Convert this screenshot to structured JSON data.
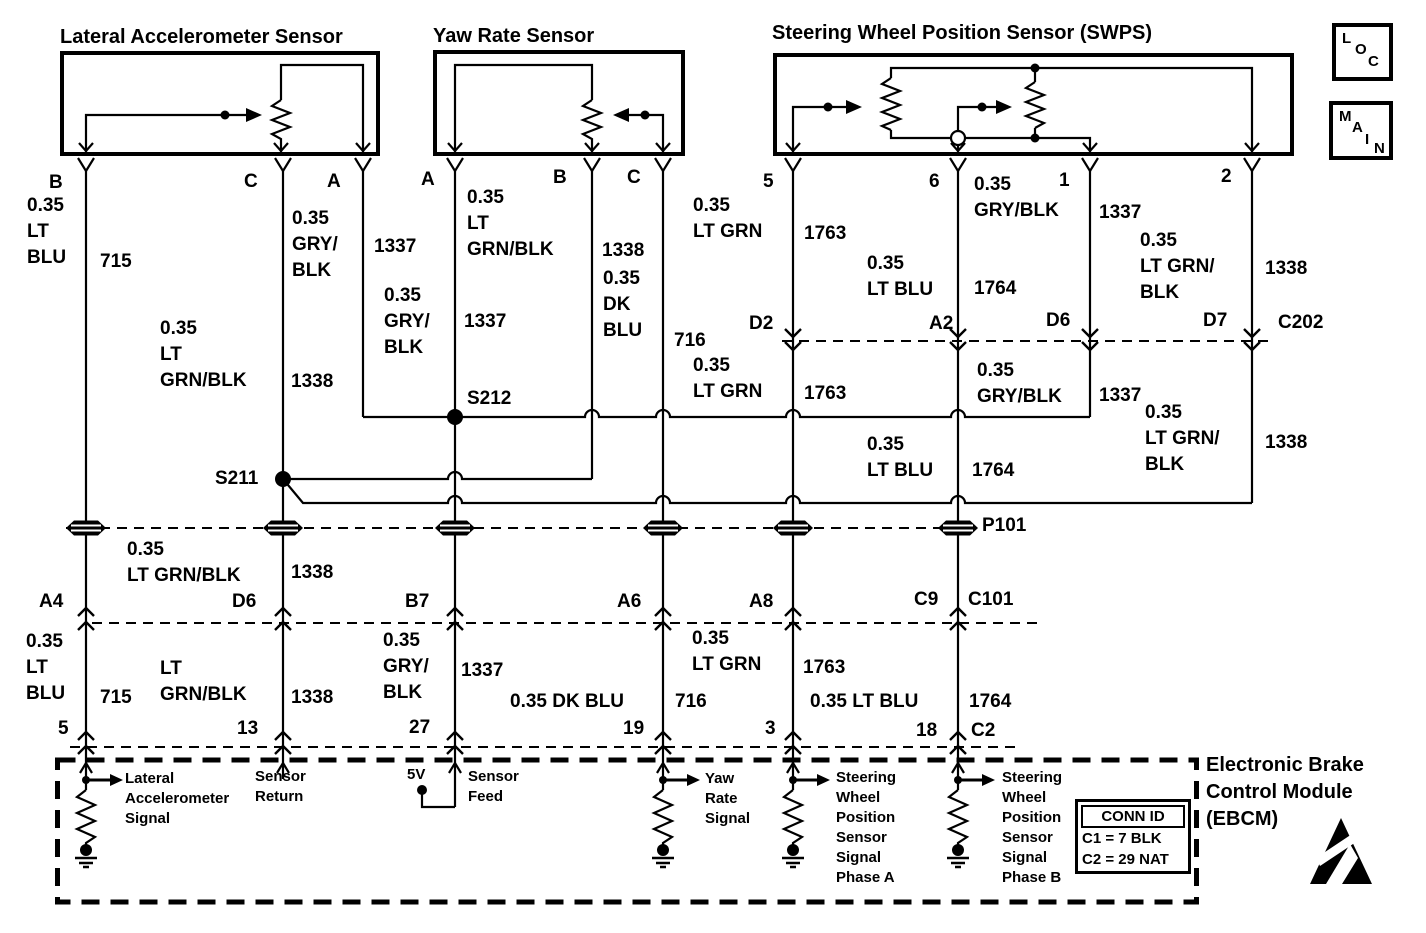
{
  "colors": {
    "ink": "#000000",
    "paper": "#ffffff"
  },
  "nav": {
    "loc": [
      "L",
      "O",
      "C"
    ],
    "main": [
      "M",
      "A",
      "I",
      "N"
    ]
  },
  "conn_id": {
    "title": "CONN ID",
    "rows": [
      "C1 = 7 BLK",
      "C2 = 29 NAT"
    ]
  },
  "ebcm": {
    "title": "Electronic Brake\nControl Module\n(EBCM)"
  },
  "labels": [
    {
      "name": "lateral-accelerometer-sensor-title",
      "text": "Lateral Accelerometer Sensor",
      "x": 60,
      "y": 24,
      "fs": 20
    },
    {
      "name": "yaw-rate-sensor-title",
      "text": "Yaw Rate Sensor",
      "x": 433,
      "y": 23,
      "fs": 20
    },
    {
      "name": "swps-title",
      "text": "Steering Wheel Position Sensor (SWPS)",
      "x": 772,
      "y": 20,
      "fs": 20
    },
    {
      "name": "lat-terminal-b",
      "text": "B",
      "x": 49,
      "y": 170
    },
    {
      "name": "lat-terminal-c",
      "text": "C",
      "x": 244,
      "y": 169
    },
    {
      "name": "lat-terminal-a",
      "text": "A",
      "x": 327,
      "y": 169
    },
    {
      "name": "yaw-terminal-a",
      "text": "A",
      "x": 421,
      "y": 167
    },
    {
      "name": "yaw-terminal-b",
      "text": "B",
      "x": 553,
      "y": 165
    },
    {
      "name": "yaw-terminal-c",
      "text": "C",
      "x": 627,
      "y": 165
    },
    {
      "name": "swps-terminal-5",
      "text": "5",
      "x": 763,
      "y": 169
    },
    {
      "name": "swps-terminal-6",
      "text": "6",
      "x": 929,
      "y": 169
    },
    {
      "name": "swps-terminal-1",
      "text": "1",
      "x": 1059,
      "y": 168
    },
    {
      "name": "swps-terminal-2",
      "text": "2",
      "x": 1221,
      "y": 164
    },
    {
      "name": "wire-715-color-top",
      "text": "0.35\nLT\nBLU",
      "x": 27,
      "y": 193
    },
    {
      "name": "wire-715-circuit-top",
      "text": "715",
      "x": 100,
      "y": 249
    },
    {
      "name": "wire-1337-lat-color",
      "text": "0.35\nGRY/\nBLK",
      "x": 292,
      "y": 206
    },
    {
      "name": "wire-1337-lat-circuit",
      "text": "1337",
      "x": 374,
      "y": 234
    },
    {
      "name": "wire-1338-lat-color",
      "text": "0.35\nLT\nGRN/BLK",
      "x": 160,
      "y": 316
    },
    {
      "name": "wire-1338-lat-circuit",
      "text": "1338",
      "x": 291,
      "y": 369
    },
    {
      "name": "wire-1337-yaw-color",
      "text": "0.35\nGRY/\nBLK",
      "x": 384,
      "y": 283
    },
    {
      "name": "wire-1337-yaw-circuit",
      "text": "1337",
      "x": 464,
      "y": 309
    },
    {
      "name": "wire-1338-yaw-color",
      "text": "0.35\nLT\nGRN/BLK",
      "x": 467,
      "y": 185
    },
    {
      "name": "wire-1338-yaw-circuit",
      "text": "1338",
      "x": 602,
      "y": 238
    },
    {
      "name": "wire-716-color-top",
      "text": "0.35\nDK\nBLU",
      "x": 603,
      "y": 266
    },
    {
      "name": "wire-716-circuit-top",
      "text": "716",
      "x": 674,
      "y": 328
    },
    {
      "name": "wire-1763-color-top",
      "text": "0.35\nLT GRN",
      "x": 693,
      "y": 193
    },
    {
      "name": "wire-1763-circuit-top",
      "text": "1763",
      "x": 804,
      "y": 221
    },
    {
      "name": "wire-1764-color-top",
      "text": "0.35\nLT BLU",
      "x": 867,
      "y": 251
    },
    {
      "name": "wire-1764-circuit-top",
      "text": "1764",
      "x": 974,
      "y": 276
    },
    {
      "name": "wire-1337-swps-color",
      "text": "0.35\nGRY/BLK",
      "x": 974,
      "y": 172
    },
    {
      "name": "wire-1337-swps-circuit",
      "text": "1337",
      "x": 1099,
      "y": 200
    },
    {
      "name": "wire-1338-swps-color",
      "text": "0.35\nLT GRN/\nBLK",
      "x": 1140,
      "y": 228
    },
    {
      "name": "wire-1338-swps-circuit",
      "text": "1338",
      "x": 1265,
      "y": 256
    },
    {
      "name": "splice-s212-label",
      "text": "S212",
      "x": 467,
      "y": 386
    },
    {
      "name": "splice-s211-label",
      "text": "S211",
      "x": 215,
      "y": 466
    },
    {
      "name": "c202-pin-d2",
      "text": "D2",
      "x": 749,
      "y": 311
    },
    {
      "name": "c202-pin-a2",
      "text": "A2",
      "x": 929,
      "y": 311
    },
    {
      "name": "c202-pin-d6",
      "text": "D6",
      "x": 1046,
      "y": 308
    },
    {
      "name": "c202-pin-d7",
      "text": "D7",
      "x": 1203,
      "y": 308
    },
    {
      "name": "c202-label",
      "text": "C202",
      "x": 1278,
      "y": 310
    },
    {
      "name": "wire-1763-color-mid",
      "text": "0.35\nLT GRN",
      "x": 693,
      "y": 353
    },
    {
      "name": "wire-1763-circuit-mid",
      "text": "1763",
      "x": 804,
      "y": 381
    },
    {
      "name": "wire-1337-color-mid",
      "text": "0.35\nGRY/BLK",
      "x": 977,
      "y": 358
    },
    {
      "name": "wire-1337-circuit-mid",
      "text": "1337",
      "x": 1099,
      "y": 383
    },
    {
      "name": "wire-1764-color-mid",
      "text": "0.35\nLT BLU",
      "x": 867,
      "y": 432
    },
    {
      "name": "wire-1764-circuit-mid",
      "text": "1764",
      "x": 972,
      "y": 458
    },
    {
      "name": "wire-1338-color-mid",
      "text": "0.35\nLT GRN/\nBLK",
      "x": 1145,
      "y": 400
    },
    {
      "name": "wire-1338-circuit-mid",
      "text": "1338",
      "x": 1265,
      "y": 430
    },
    {
      "name": "p101-label",
      "text": "P101",
      "x": 982,
      "y": 513
    },
    {
      "name": "wire-1338-color-p101",
      "text": "0.35\nLT GRN/BLK",
      "x": 127,
      "y": 537
    },
    {
      "name": "wire-1338-circuit-p101",
      "text": "1338",
      "x": 291,
      "y": 560
    },
    {
      "name": "c101-pin-a4",
      "text": "A4",
      "x": 39,
      "y": 589
    },
    {
      "name": "c101-pin-d6",
      "text": "D6",
      "x": 232,
      "y": 589
    },
    {
      "name": "c101-pin-b7",
      "text": "B7",
      "x": 405,
      "y": 589
    },
    {
      "name": "c101-pin-a6",
      "text": "A6",
      "x": 617,
      "y": 589
    },
    {
      "name": "c101-pin-a8",
      "text": "A8",
      "x": 749,
      "y": 589
    },
    {
      "name": "c101-pin-c9",
      "text": "C9",
      "x": 914,
      "y": 587
    },
    {
      "name": "c101-label",
      "text": "C101",
      "x": 968,
      "y": 587
    },
    {
      "name": "wire-715-color-bottom",
      "text": "0.35\nLT\nBLU",
      "x": 26,
      "y": 629
    },
    {
      "name": "wire-715-circuit-bottom",
      "text": "715",
      "x": 100,
      "y": 685
    },
    {
      "name": "wire-1338-color-bottom",
      "text": "LT\nGRN/BLK",
      "x": 160,
      "y": 656
    },
    {
      "name": "wire-1338-circuit-bottom",
      "text": "1338",
      "x": 291,
      "y": 685
    },
    {
      "name": "wire-1337-color-bottom",
      "text": "0.35\nGRY/\nBLK",
      "x": 383,
      "y": 628
    },
    {
      "name": "wire-1337-circuit-bottom",
      "text": "1337",
      "x": 461,
      "y": 658
    },
    {
      "name": "wire-716-color-bottom",
      "text": "0.35 DK BLU",
      "x": 510,
      "y": 689
    },
    {
      "name": "wire-716-circuit-bottom",
      "text": "716",
      "x": 675,
      "y": 689
    },
    {
      "name": "wire-1763-color-bottom",
      "text": "0.35\nLT GRN",
      "x": 692,
      "y": 626
    },
    {
      "name": "wire-1763-circuit-bottom",
      "text": "1763",
      "x": 803,
      "y": 655
    },
    {
      "name": "wire-1764-color-bottom",
      "text": "0.35 LT BLU",
      "x": 810,
      "y": 689
    },
    {
      "name": "wire-1764-circuit-bottom",
      "text": "1764",
      "x": 969,
      "y": 689
    },
    {
      "name": "ebcm-pin-5",
      "text": "5",
      "x": 58,
      "y": 716
    },
    {
      "name": "ebcm-pin-13",
      "text": "13",
      "x": 237,
      "y": 716
    },
    {
      "name": "ebcm-pin-27",
      "text": "27",
      "x": 409,
      "y": 715
    },
    {
      "name": "ebcm-pin-19",
      "text": "19",
      "x": 623,
      "y": 716
    },
    {
      "name": "ebcm-pin-3",
      "text": "3",
      "x": 765,
      "y": 716
    },
    {
      "name": "ebcm-pin-18",
      "text": "18",
      "x": 916,
      "y": 718
    },
    {
      "name": "ebcm-connector-c2",
      "text": "C2",
      "x": 971,
      "y": 718
    },
    {
      "name": "ebcm-lateral-accel-signal-label",
      "text": "Lateral\nAccelerometer\nSignal",
      "x": 125,
      "y": 769,
      "fs": 15
    },
    {
      "name": "ebcm-sensor-return-label",
      "text": "Sensor\nReturn",
      "x": 255,
      "y": 767,
      "fs": 15
    },
    {
      "name": "ebcm-5v-label",
      "text": "5V",
      "x": 407,
      "y": 765,
      "fs": 15
    },
    {
      "name": "ebcm-sensor-feed-label",
      "text": "Sensor\nFeed",
      "x": 468,
      "y": 767,
      "fs": 15
    },
    {
      "name": "ebcm-yaw-rate-signal-label",
      "text": "Yaw\nRate\nSignal",
      "x": 705,
      "y": 769,
      "fs": 15
    },
    {
      "name": "ebcm-swps-phase-a-label",
      "text": "Steering\nWheel\nPosition\nSensor\nSignal\nPhase A",
      "x": 836,
      "y": 768,
      "fs": 15
    },
    {
      "name": "ebcm-swps-phase-b-label",
      "text": "Steering\nWheel\nPosition\nSensor\nSignal\nPhase B",
      "x": 1002,
      "y": 768,
      "fs": 15
    }
  ]
}
